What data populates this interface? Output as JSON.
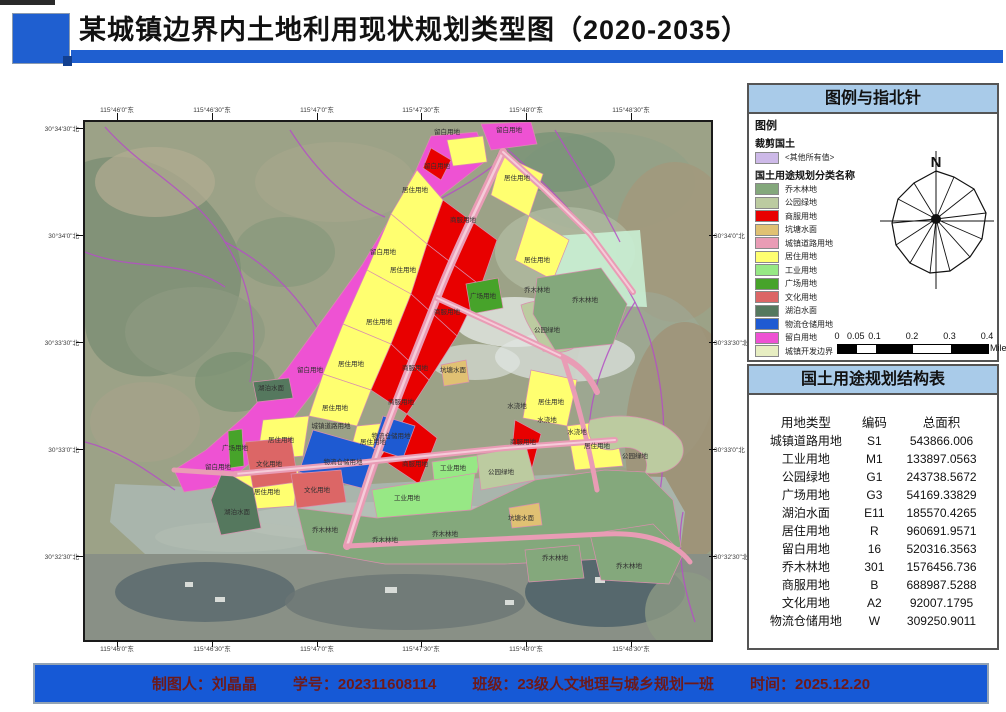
{
  "header": {
    "title": "某城镇边界内土地利用现状规划类型图（2020-2035）",
    "accent_color": "#1f5fd0"
  },
  "legend_panel": {
    "title": "图例与指北针",
    "legend_label": "图例",
    "clip_group_label": "裁剪国土",
    "clip_item_label": "<其他所有值>",
    "clip_item_color": "#cdb9e8",
    "classes_group_label": "国土用途规划分类名称",
    "items": [
      {
        "label": "乔木林地",
        "color": "#84a87c"
      },
      {
        "label": "公园绿地",
        "color": "#bccba0"
      },
      {
        "label": "商服用地",
        "color": "#e80000"
      },
      {
        "label": "坑塘水面",
        "color": "#e0c173"
      },
      {
        "label": "城镇道路用地",
        "color": "#e99cb5"
      },
      {
        "label": "居住用地",
        "color": "#ffff70"
      },
      {
        "label": "工业用地",
        "color": "#97e885"
      },
      {
        "label": "广场用地",
        "color": "#47a32a"
      },
      {
        "label": "文化用地",
        "color": "#dc6666"
      },
      {
        "label": "湖泊水面",
        "color": "#55785e"
      },
      {
        "label": "物流仓储用地",
        "color": "#1e5ad2"
      },
      {
        "label": "留白用地",
        "color": "#ee52d3"
      },
      {
        "label": "城镇开发边界",
        "color": "#e7eec2"
      }
    ],
    "north_label": "N",
    "scale": {
      "ticks": [
        {
          "t": "0",
          "f": 0
        },
        {
          "t": "0.05",
          "f": 0.125
        },
        {
          "t": "0.1",
          "f": 0.25
        },
        {
          "t": "0.2",
          "f": 0.5
        },
        {
          "t": "0.3",
          "f": 0.75
        },
        {
          "t": "0.4",
          "f": 1
        }
      ],
      "segments": [
        "#000",
        "#fff",
        "#000",
        "#fff",
        "#000"
      ],
      "unit": "Miles"
    }
  },
  "table_panel": {
    "title": "国土用途规划结构表",
    "headers": [
      "用地类型",
      "编码",
      "总面积"
    ],
    "rows": [
      [
        "城镇道路用地",
        "S1",
        "543866.006"
      ],
      [
        "工业用地",
        "M1",
        "133897.0563"
      ],
      [
        "公园绿地",
        "G1",
        "243738.5672"
      ],
      [
        "广场用地",
        "G3",
        "54169.33829"
      ],
      [
        "湖泊水面",
        "E11",
        "185570.4265"
      ],
      [
        "居住用地",
        "R",
        "960691.9571"
      ],
      [
        "留白用地",
        "16",
        "520316.3563"
      ],
      [
        "乔木林地",
        "301",
        "1576456.736"
      ],
      [
        "商服用地",
        "B",
        "688987.5288"
      ],
      [
        "文化用地",
        "A2",
        "92007.1795"
      ],
      [
        "物流仓储用地",
        "W",
        "309250.9011"
      ]
    ]
  },
  "map": {
    "graticule": {
      "top": [
        {
          "x": 117,
          "t": "115°46'0\"东"
        },
        {
          "x": 212,
          "t": "115°46'30\"东"
        },
        {
          "x": 317,
          "t": "115°47'0\"东"
        },
        {
          "x": 421,
          "t": "115°47'30\"东"
        },
        {
          "x": 526,
          "t": "115°48'0\"东"
        },
        {
          "x": 631,
          "t": "115°48'30\"东"
        }
      ],
      "bottom": [
        {
          "x": 117,
          "t": "115°46'0\"东"
        },
        {
          "x": 212,
          "t": "115°46'30\"东"
        },
        {
          "x": 317,
          "t": "115°47'0\"东"
        },
        {
          "x": 421,
          "t": "115°47'30\"东"
        },
        {
          "x": 526,
          "t": "115°48'0\"东"
        },
        {
          "x": 631,
          "t": "115°48'30\"东"
        }
      ],
      "left": [
        {
          "y": 128,
          "t": "30°34'30\"北"
        },
        {
          "y": 235,
          "t": "30°34'0\"北"
        },
        {
          "y": 342,
          "t": "30°33'30\"北"
        },
        {
          "y": 449,
          "t": "30°33'0\"北"
        },
        {
          "y": 556,
          "t": "30°32'30\"北"
        }
      ],
      "right": [
        {
          "y": 235,
          "t": "30°34'0\"北"
        },
        {
          "y": 342,
          "t": "30°33'30\"北"
        },
        {
          "y": 449,
          "t": "30°33'0\"北"
        },
        {
          "y": 556,
          "t": "30°32'30\"北"
        }
      ]
    },
    "labels": [
      {
        "x": 362,
        "y": 12,
        "t": "留白用地"
      },
      {
        "x": 424,
        "y": 10,
        "t": "留白用地"
      },
      {
        "x": 352,
        "y": 46,
        "t": "留白用地"
      },
      {
        "x": 298,
        "y": 132,
        "t": "留白用地"
      },
      {
        "x": 225,
        "y": 250,
        "t": "留白用地"
      },
      {
        "x": 133,
        "y": 347,
        "t": "留白用地"
      },
      {
        "x": 330,
        "y": 70,
        "t": "居住用地"
      },
      {
        "x": 318,
        "y": 150,
        "t": "居住用地"
      },
      {
        "x": 294,
        "y": 202,
        "t": "居住用地"
      },
      {
        "x": 266,
        "y": 244,
        "t": "居住用地"
      },
      {
        "x": 250,
        "y": 288,
        "t": "居住用地"
      },
      {
        "x": 432,
        "y": 58,
        "t": "居住用地"
      },
      {
        "x": 452,
        "y": 140,
        "t": "居住用地"
      },
      {
        "x": 466,
        "y": 282,
        "t": "居住用地"
      },
      {
        "x": 512,
        "y": 326,
        "t": "居住用地"
      },
      {
        "x": 196,
        "y": 320,
        "t": "居住用地"
      },
      {
        "x": 182,
        "y": 372,
        "t": "居住用地"
      },
      {
        "x": 288,
        "y": 322,
        "t": "居住用地"
      },
      {
        "x": 378,
        "y": 100,
        "t": "商服用地"
      },
      {
        "x": 362,
        "y": 192,
        "t": "商服用地"
      },
      {
        "x": 330,
        "y": 248,
        "t": "商服用地"
      },
      {
        "x": 316,
        "y": 282,
        "t": "商服用地"
      },
      {
        "x": 330,
        "y": 344,
        "t": "商服用地"
      },
      {
        "x": 438,
        "y": 322,
        "t": "商服用地"
      },
      {
        "x": 398,
        "y": 176,
        "t": "广场用地"
      },
      {
        "x": 150,
        "y": 328,
        "t": "广场用地"
      },
      {
        "x": 322,
        "y": 378,
        "t": "工业用地"
      },
      {
        "x": 368,
        "y": 348,
        "t": "工业用地"
      },
      {
        "x": 184,
        "y": 344,
        "t": "文化用地"
      },
      {
        "x": 232,
        "y": 370,
        "t": "文化用地"
      },
      {
        "x": 258,
        "y": 342,
        "t": "物流仓储用地"
      },
      {
        "x": 306,
        "y": 316,
        "t": "物流仓储用地"
      },
      {
        "x": 246,
        "y": 306,
        "t": "城镇道路用地"
      },
      {
        "x": 462,
        "y": 210,
        "t": "公园绿地"
      },
      {
        "x": 550,
        "y": 336,
        "t": "公园绿地"
      },
      {
        "x": 416,
        "y": 352,
        "t": "公园绿地"
      },
      {
        "x": 452,
        "y": 170,
        "t": "乔木林地"
      },
      {
        "x": 500,
        "y": 180,
        "t": "乔木林地"
      },
      {
        "x": 360,
        "y": 414,
        "t": "乔木林地"
      },
      {
        "x": 300,
        "y": 420,
        "t": "乔木林地"
      },
      {
        "x": 240,
        "y": 410,
        "t": "乔木林地"
      },
      {
        "x": 470,
        "y": 438,
        "t": "乔木林地"
      },
      {
        "x": 544,
        "y": 446,
        "t": "乔木林地"
      },
      {
        "x": 152,
        "y": 392,
        "t": "湖泊水面"
      },
      {
        "x": 186,
        "y": 268,
        "t": "湖泊水面"
      },
      {
        "x": 368,
        "y": 250,
        "t": "坑塘水面"
      },
      {
        "x": 436,
        "y": 398,
        "t": "坑塘水面"
      },
      {
        "x": 432,
        "y": 286,
        "t": "水浇地"
      },
      {
        "x": 462,
        "y": 300,
        "t": "水浇地"
      },
      {
        "x": 492,
        "y": 312,
        "t": "水浇地"
      }
    ]
  },
  "footer": {
    "maker": "制图人：刘晶晶",
    "student_id": "学号：202311608114",
    "class": "班级：23级人文地理与城乡规划一班",
    "date": "时间：2025.12.20"
  }
}
